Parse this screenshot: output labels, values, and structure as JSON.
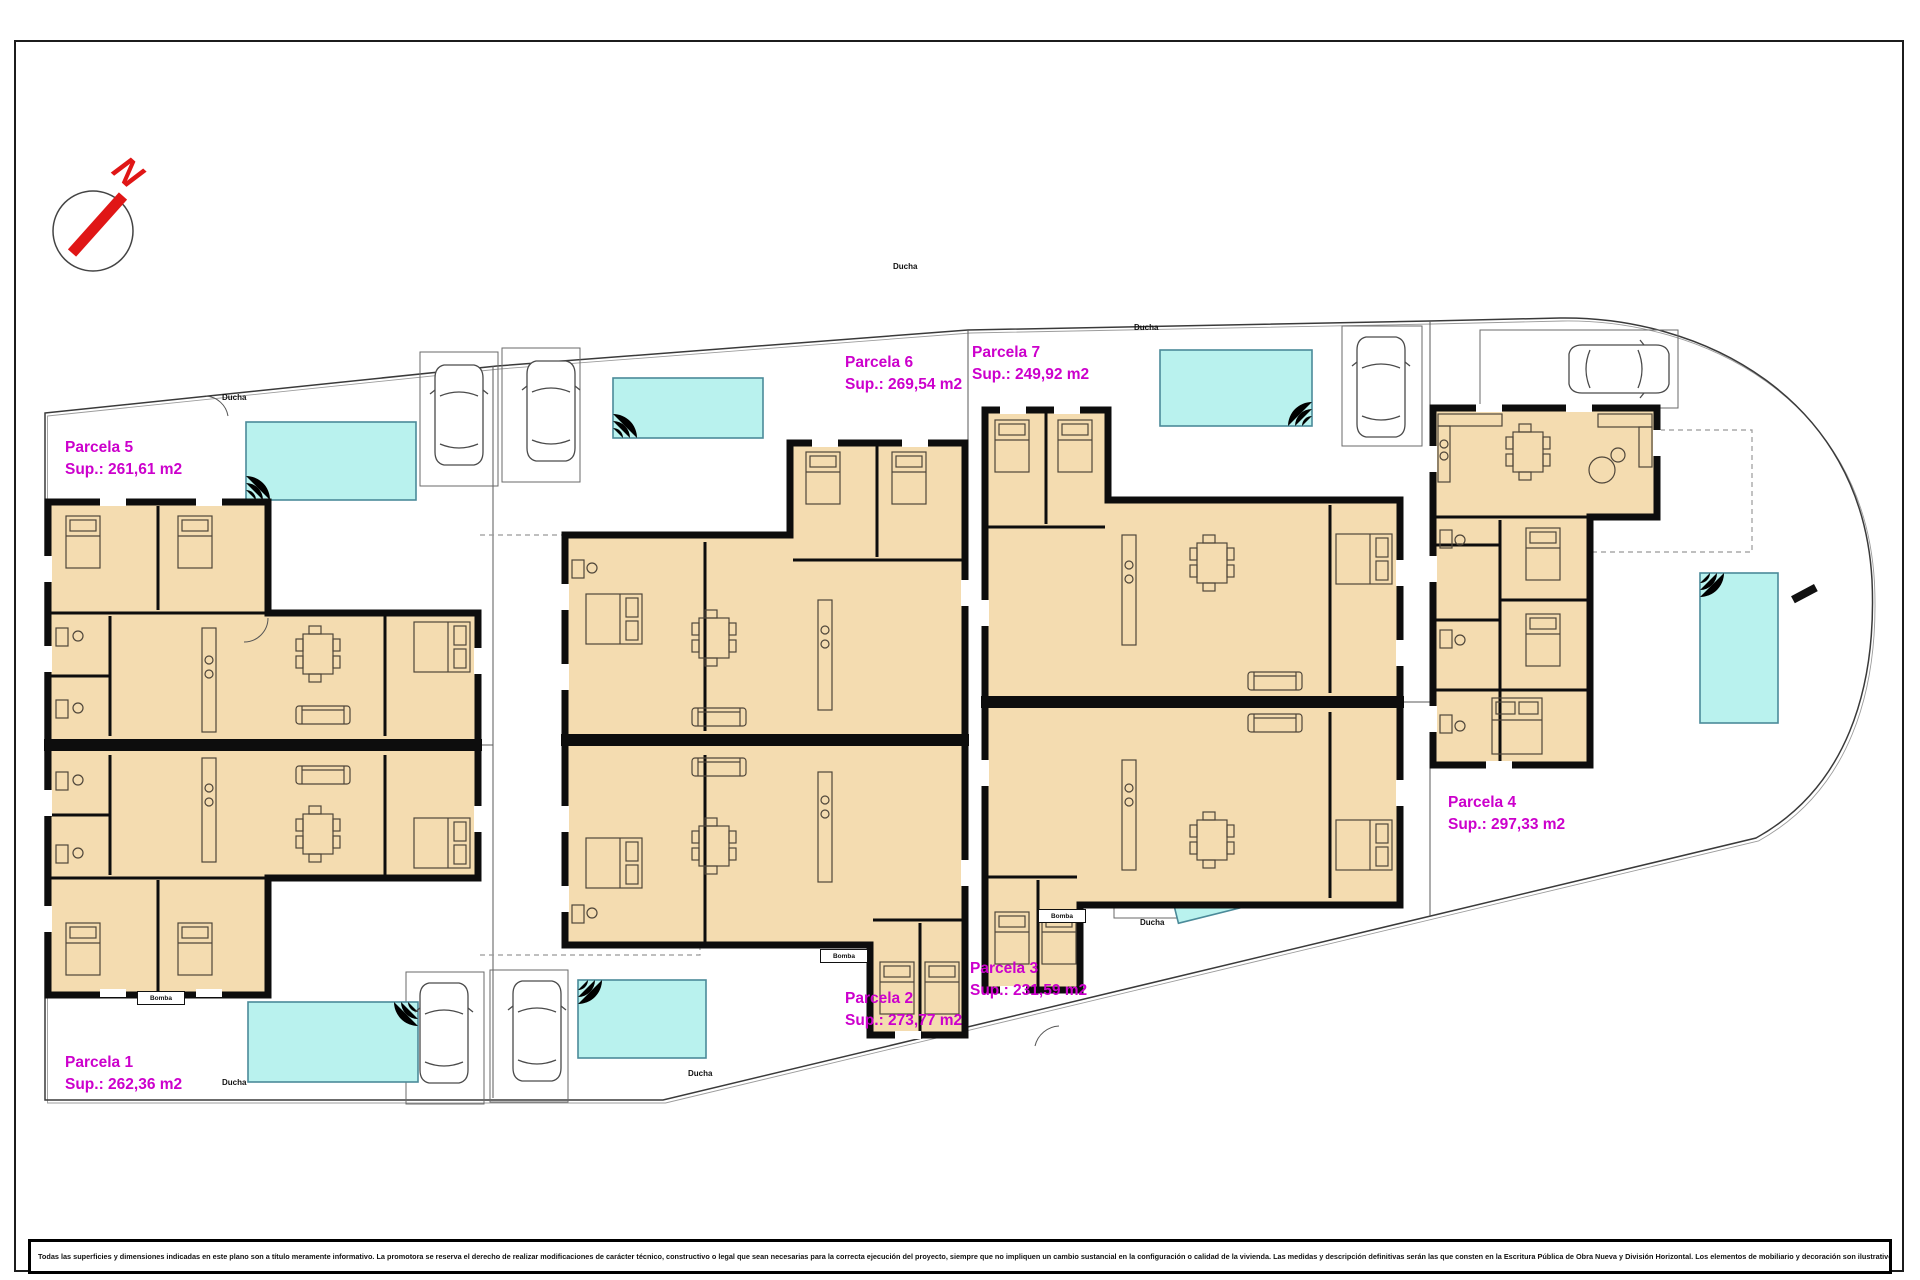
{
  "compass": {
    "letter": "N"
  },
  "parcels": [
    {
      "name": "Parcela 1",
      "area": "Sup.: 262,36 m2"
    },
    {
      "name": "Parcela 2",
      "area": "Sup.: 273,77 m2"
    },
    {
      "name": "Parcela 3",
      "area": "Sup.: 231,59 m2"
    },
    {
      "name": "Parcela 4",
      "area": "Sup.: 297,33 m2"
    },
    {
      "name": "Parcela 5",
      "area": "Sup.: 261,61 m2"
    },
    {
      "name": "Parcela 6",
      "area": "Sup.: 269,54 m2"
    },
    {
      "name": "Parcela 7",
      "area": "Sup.: 249,92 m2"
    }
  ],
  "annotations": {
    "shower": "Ducha",
    "pump": "Bomba"
  },
  "footer": {
    "disclaimer": "Todas las superficies y dimensiones indicadas en este plano son a título meramente informativo. La promotora se reserva el derecho de realizar modificaciones de carácter técnico, constructivo o legal que sean necesarias para la correcta ejecución del proyecto, siempre que no impliquen un cambio sustancial en la configuración o calidad de la vivienda. Las medidas y descripción definitivas serán las que consten en la Escritura Pública de Obra Nueva y División Horizontal. Los elementos de mobiliario y decoración son ilustrativos y no están incluidos."
  },
  "colors": {
    "accent_magenta": "#cc00cc",
    "pool_fill": "#b9f2ee",
    "pool_border": "#4b8a99",
    "building_fill": "#f4dcb0",
    "wall": "#0d0d0d",
    "north_red": "#e01616"
  }
}
